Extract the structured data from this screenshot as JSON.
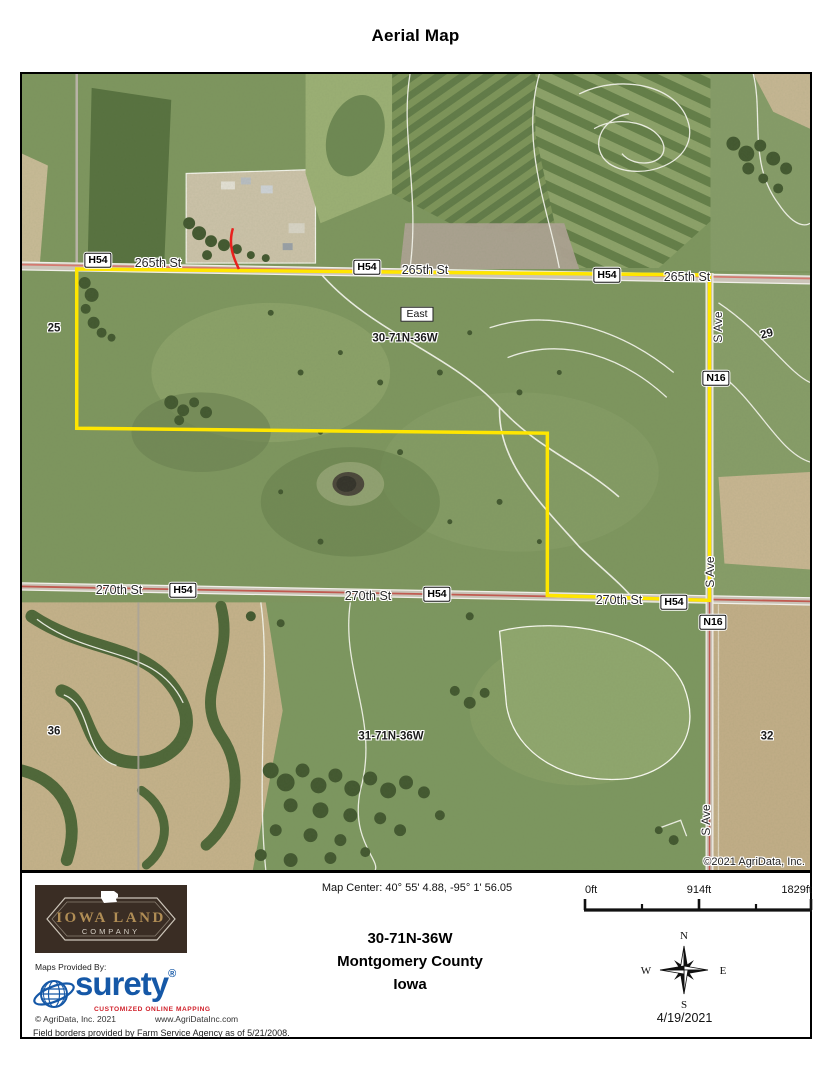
{
  "page": {
    "title": "Aerial Map"
  },
  "map": {
    "labels": {
      "st265": "265th St",
      "st270": "270th St",
      "s_ave": "S Ave",
      "h54": "H54",
      "n16": "N16",
      "east": "East",
      "sec25": "25",
      "sec29": "29",
      "sec32": "32",
      "sec36": "36",
      "twp30": "30-71N-36W",
      "twp31": "31-71N-36W",
      "copyright": "©2021 AgriData, Inc."
    },
    "boundary_color": "#ffe600"
  },
  "footer": {
    "map_center": "Map Center: 40° 55' 4.88,  -95° 1' 56.05",
    "township": "30-71N-36W",
    "county": "Montgomery County",
    "state": "Iowa",
    "date": "4/19/2021",
    "scale": {
      "zero": "0ft",
      "mid": "914ft",
      "max": "1829ft"
    },
    "compass": {
      "n": "N",
      "e": "E",
      "s": "S",
      "w": "W"
    },
    "iowa_land": {
      "name": "IOWA LAND",
      "subtitle": "COMPANY",
      "brown": "#3a2d24",
      "gold": "#b08d55"
    },
    "provided_by": "Maps Provided By:",
    "surety": {
      "name": "surety",
      "registered": "®",
      "tagline": "CUSTOMIZED ONLINE MAPPING",
      "copyright": "© AgriData, Inc. 2021",
      "website": "www.AgriDataInc.com",
      "blue": "#1558a7",
      "red": "#d0202a"
    }
  },
  "disclaimer": "Field borders provided by Farm Service Agency as of 5/21/2008."
}
